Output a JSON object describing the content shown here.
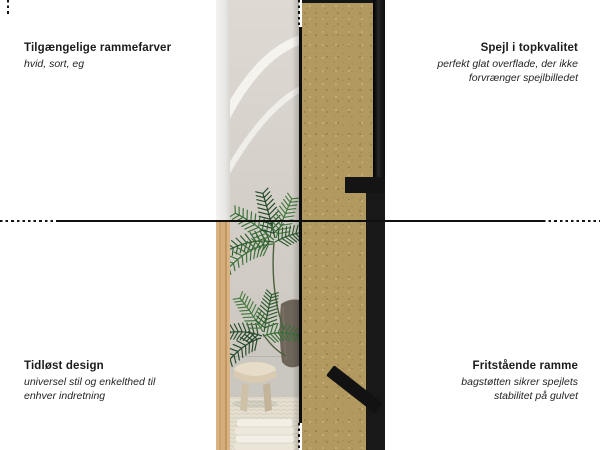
{
  "canvas": {
    "background": "#ffffff",
    "line_color": "#111111",
    "text_color": "#1b1b1b"
  },
  "annotations": {
    "top_left": {
      "title": "Tilgængelige rammefarver",
      "subtitle": "hvid, sort, eg"
    },
    "top_right": {
      "title": "Spejl i topkvalitet",
      "subtitle": "perfekt glat overflade, der ikke forvrænger spejlbilledet"
    },
    "bottom_left": {
      "title": "Tidløst design",
      "subtitle": "universel stil og enkelthed til enhver indretning"
    },
    "bottom_right": {
      "title": "Fritstående ramme",
      "subtitle": "bagstøtten sikrer spejlets stabilitet på gulvet"
    }
  },
  "product_photo": {
    "colors": {
      "mdf_back": "#b2995f",
      "frame_black": "#141414",
      "frame_white": "#edebe8",
      "frame_oak": "#d2ab79",
      "wall": "#d6d2cb",
      "plant_greens": [
        "#2c5a2d",
        "#3a7038",
        "#24492a",
        "#457a40"
      ],
      "pot": "#6e655a",
      "floor": "#cac7c0",
      "rug": "#e4dfd1"
    }
  }
}
